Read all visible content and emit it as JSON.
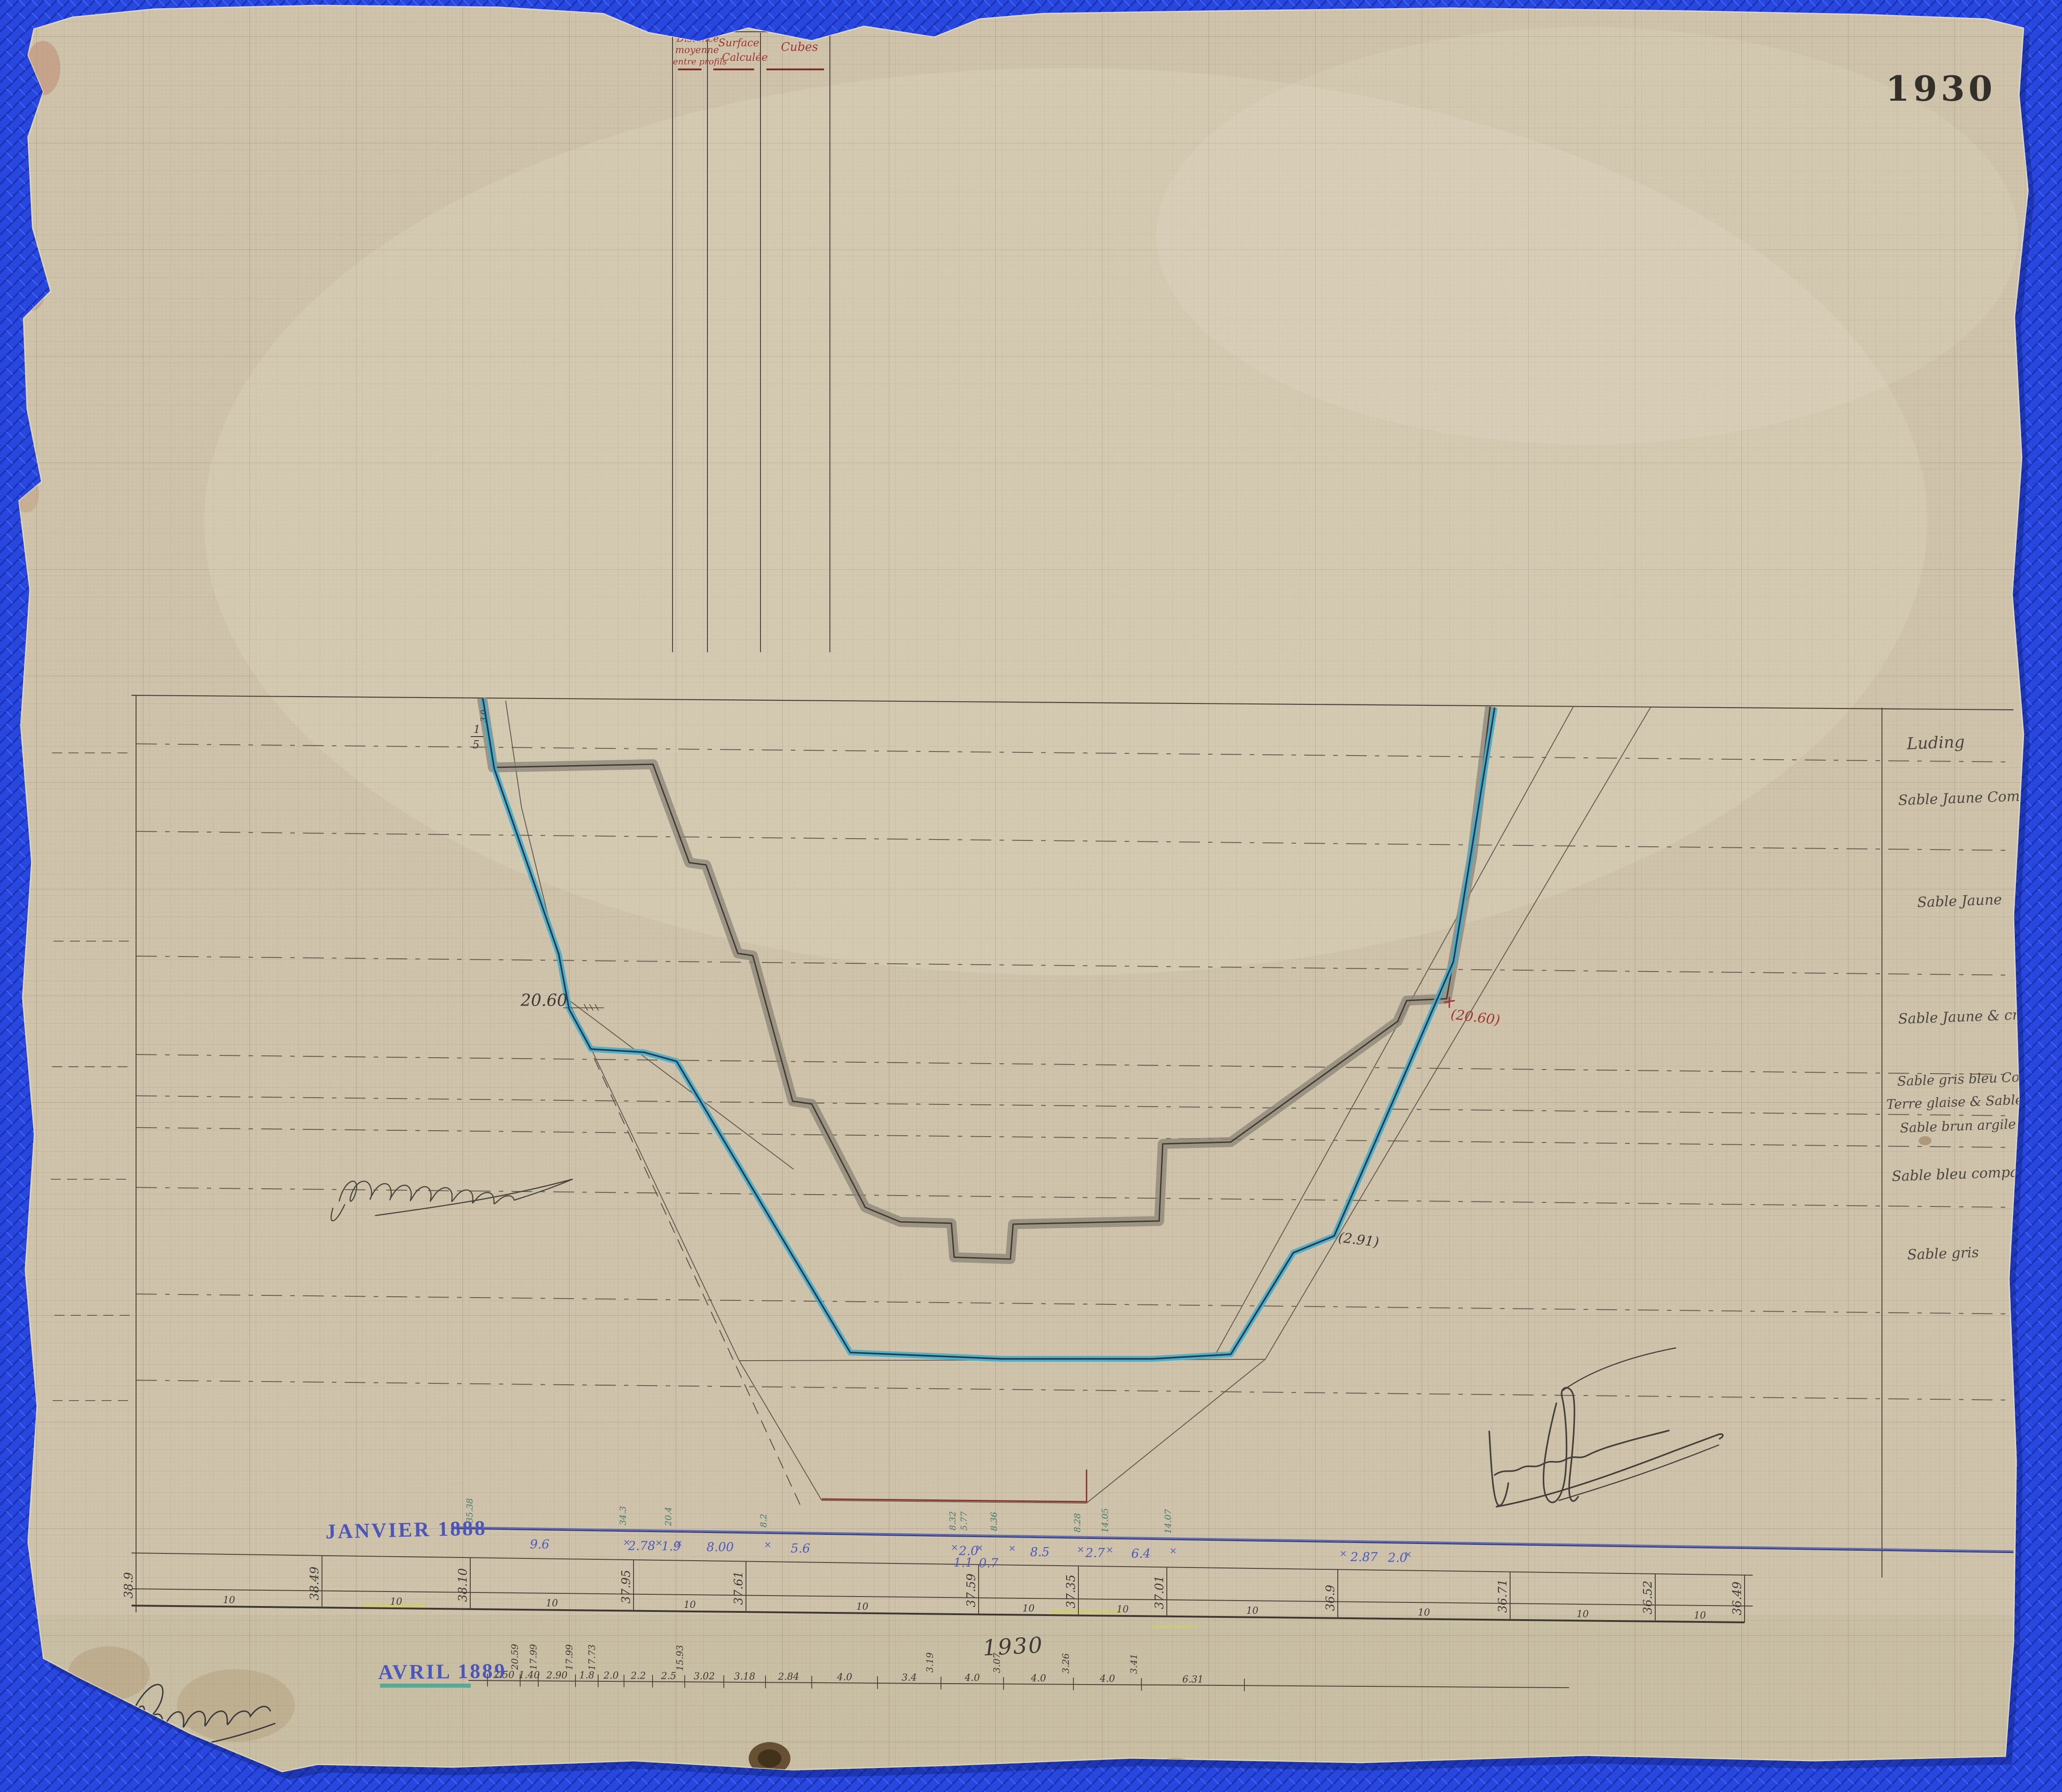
{
  "doc": {
    "plate_top_right": "1930",
    "plate_bottom": "1930"
  },
  "table": {
    "col1_lines": [
      "Distance",
      "moyenne",
      "entre profils"
    ],
    "col2_lines": [
      "Surface",
      "Calculée"
    ],
    "col3_label": "Cubes"
  },
  "stamps": {
    "janvier": "JANVIER 1888",
    "avril": "AVRIL 1889"
  },
  "soil_layers": [
    "Luding",
    "Sable Jaune Compac",
    "Sable Jaune",
    "Sable Jaune & craie",
    "Sable gris bleu Com",
    "Terre glaise & Sable",
    "Sable brun argile",
    "Sable bleu compa",
    "Sable gris"
  ],
  "annotations": {
    "bench_left": "20.60",
    "bench_right": "(20.60)",
    "toe_right": "(2.91)",
    "slope_num": "1",
    "slope_den": "5",
    "crest_note": "3.0"
  },
  "station_scale": {
    "spacing_label": "10",
    "elevations": [
      "38.9",
      "38.49",
      "38.10",
      "37.95",
      "37.61",
      "37.59",
      "37.35",
      "37.01",
      "36.9",
      "36.71",
      "36.52",
      "36.49"
    ]
  },
  "janvier_1888": {
    "x_mark": "×",
    "depths": [
      "9.6",
      "2.78",
      "1.9",
      "8.00",
      "5.6",
      "2.0",
      "1.1",
      "0.7",
      "8.5",
      "2.7",
      "6.4",
      "2.87",
      "2.0"
    ],
    "heights": [
      "35.38",
      "34.3",
      "20.4",
      "8.2",
      "8.32",
      "5.77",
      "8.36",
      "8.28",
      "14.05",
      "14.07"
    ]
  },
  "avril_1889": {
    "widths": [
      "2.50",
      "1.40",
      "2.90",
      "1.8",
      "2.0",
      "2.2",
      "2.5",
      "3.02",
      "3.18",
      "2.84",
      "4.0",
      "3.4",
      "4.0",
      "4.0",
      "4.0",
      "6.31"
    ],
    "elevations": [
      "20.59",
      "17.99",
      "17.99",
      "17.73",
      "15.93",
      "3.19",
      "3.07",
      "3.26",
      "3.41"
    ]
  },
  "signatures": {
    "mid_left": "illegible-cursive-annotation",
    "bottom_left": "illegible-signature",
    "bottom_right": "illegible-signature"
  },
  "colors": {
    "background_blue": "#2747de",
    "paper": "#cfc4ab",
    "profile_1930_gray": "#8f8779",
    "profile_1888_blue": "#47aec6",
    "stamp_blue": "#4a57b8",
    "red_ink": "#a03432",
    "teal_ink": "#3f7a6a",
    "red_line": "#8a2f28"
  }
}
